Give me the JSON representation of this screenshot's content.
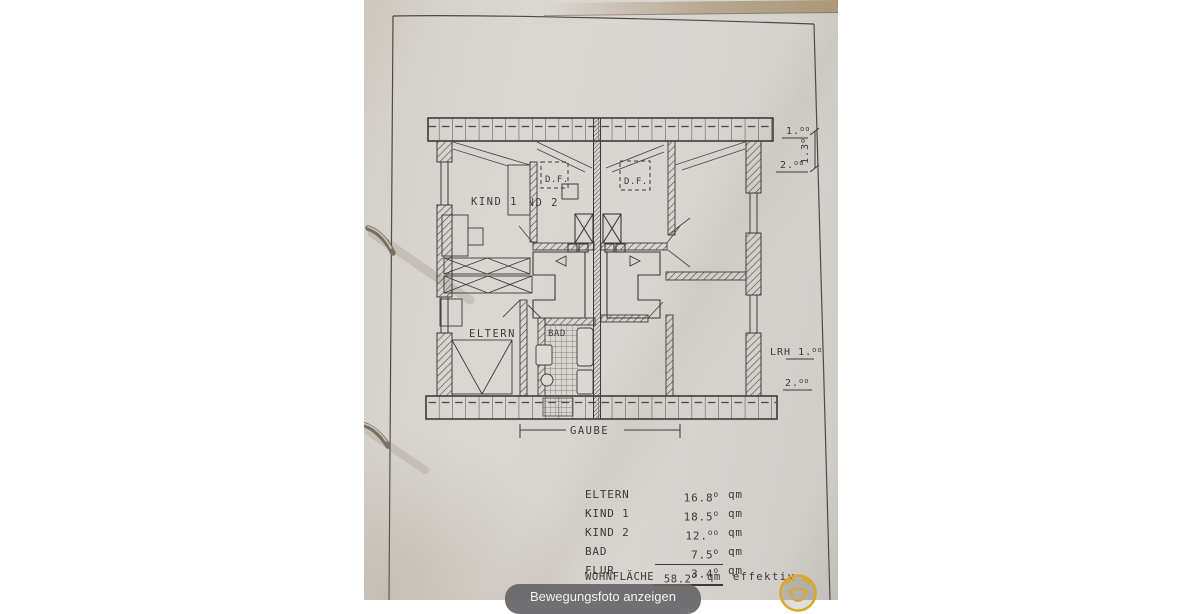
{
  "plan": {
    "labels": {
      "kind1": "KIND 1",
      "kind2": "KIND 2",
      "eltern": "ELTERN",
      "bad": "BAD",
      "df_left": "D.F.",
      "df_right": "D.F.",
      "gaube": "GAUBE"
    },
    "dims": {
      "d1": {
        "main": "1.",
        "sup": "oo"
      },
      "d2": {
        "main": "1.3",
        "sup": "o"
      },
      "d3": {
        "main": "2.",
        "sup": "oo"
      },
      "d4": {
        "main": "LRH 1.",
        "sup": "oo"
      },
      "d5": {
        "main": "2.",
        "sup": "oo"
      }
    }
  },
  "table": {
    "rows": [
      {
        "label": "ELTERN",
        "value": "16.8",
        "sup": "o",
        "unit": "qm"
      },
      {
        "label": "KIND 1",
        "value": "18.5",
        "sup": "o",
        "unit": "qm"
      },
      {
        "label": "KIND 2",
        "value": "12.",
        "sup": "oo",
        "unit": "qm"
      },
      {
        "label": "BAD",
        "value": "7.5",
        "sup": "o",
        "unit": "qm"
      },
      {
        "label": "FLUR",
        "value": "3.4",
        "sup": "o",
        "unit": "qm"
      }
    ],
    "total": {
      "label": "WOHNFLÄCHE",
      "value": "58.2",
      "sup": "o",
      "unit": "qm",
      "suffix": "effektiv"
    }
  },
  "overlay": {
    "chip_label": "Bewegungsfoto anzeigen"
  },
  "icons": {
    "logo": "bear-face-logo",
    "fastener": "paper-fastener"
  },
  "colors": {
    "paper": "#d8d5d1",
    "ink": "#3b3b3b",
    "chip_bg": "#656567",
    "logo_yellow": "#d9a82a"
  }
}
